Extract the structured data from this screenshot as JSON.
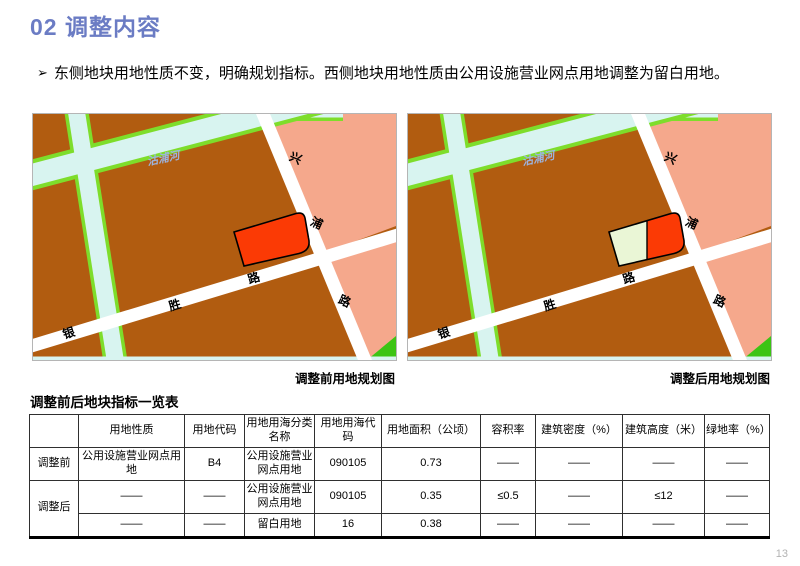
{
  "slide": {
    "title": "02 调整内容",
    "bullet_marker": "➢",
    "bullet_text": "东侧地块用地性质不变，明确规划指标。西侧地块用地性质由公用设施营业网点用地调整为留白用地。",
    "page_number": "13"
  },
  "maps": {
    "labels": {
      "river": "沽浦河",
      "road_xingpu": [
        "兴",
        "浦",
        "路"
      ],
      "road_yinsheng": [
        "银",
        "胜",
        "路"
      ]
    },
    "before": {
      "caption": "调整前用地规划图"
    },
    "after": {
      "caption": "调整后用地规划图"
    }
  },
  "colors": {
    "title_blue": "#6b7cc4",
    "land_brown": "#b15c10",
    "residential_pink": "#f5a88c",
    "river_cyan": "#d8f4f0",
    "bank_green": "#7edd2b",
    "green_space": "#3cc414",
    "road_white": "#ffffff",
    "parcel_red": "#fb3a05",
    "parcel_reserved_cream": "#eaf6d6",
    "river_label_blue": "#9db4de"
  },
  "table": {
    "title": "调整前后地块指标一览表",
    "headers": [
      "",
      "用地性质",
      "用地代码",
      "用地用海分类名称",
      "用地用海代码",
      "用地面积（公顷）",
      "容积率",
      "建筑密度（%）",
      "建筑高度（米）",
      "绿地率（%）"
    ],
    "rows": [
      {
        "label": "调整前",
        "cells": [
          "公用设施营业网点用地",
          "B4",
          "公用设施营业网点用地",
          "090105",
          "0.73",
          "——",
          "——",
          "——",
          "——"
        ]
      },
      {
        "label": "调整后",
        "cells": [
          "——",
          "——",
          "公用设施营业网点用地",
          "090105",
          "0.35",
          "≤0.5",
          "——",
          "≤12",
          "——"
        ]
      },
      {
        "label": "",
        "cells": [
          "——",
          "——",
          "留白用地",
          "16",
          "0.38",
          "——",
          "——",
          "——",
          "——"
        ]
      }
    ]
  }
}
